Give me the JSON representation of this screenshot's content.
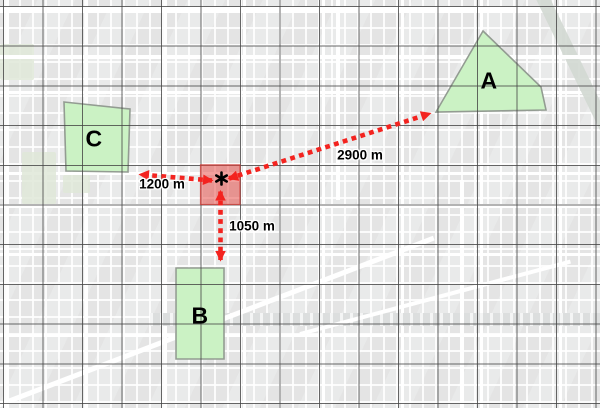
{
  "map": {
    "zones": [
      {
        "name": "A",
        "distance_from_marker": "2900 m"
      },
      {
        "name": "B",
        "distance_from_marker": "1050 m"
      },
      {
        "name": "C",
        "distance_from_marker": "1200 m"
      }
    ],
    "marker": {
      "icon": "asterisk-point-icon"
    },
    "measurement_unit": "m"
  },
  "colors": {
    "zone_fill": "#cbf2c4",
    "zone_stroke": "#939c92",
    "measure_red": "#f3231f",
    "highlight_fill": "#e8423c",
    "grid_line": "#4c4c4c",
    "basemap_bg": "#e9eaea",
    "road_white": "#ffffff",
    "park_green": "#dfe8d8",
    "label_black": "#000000"
  }
}
